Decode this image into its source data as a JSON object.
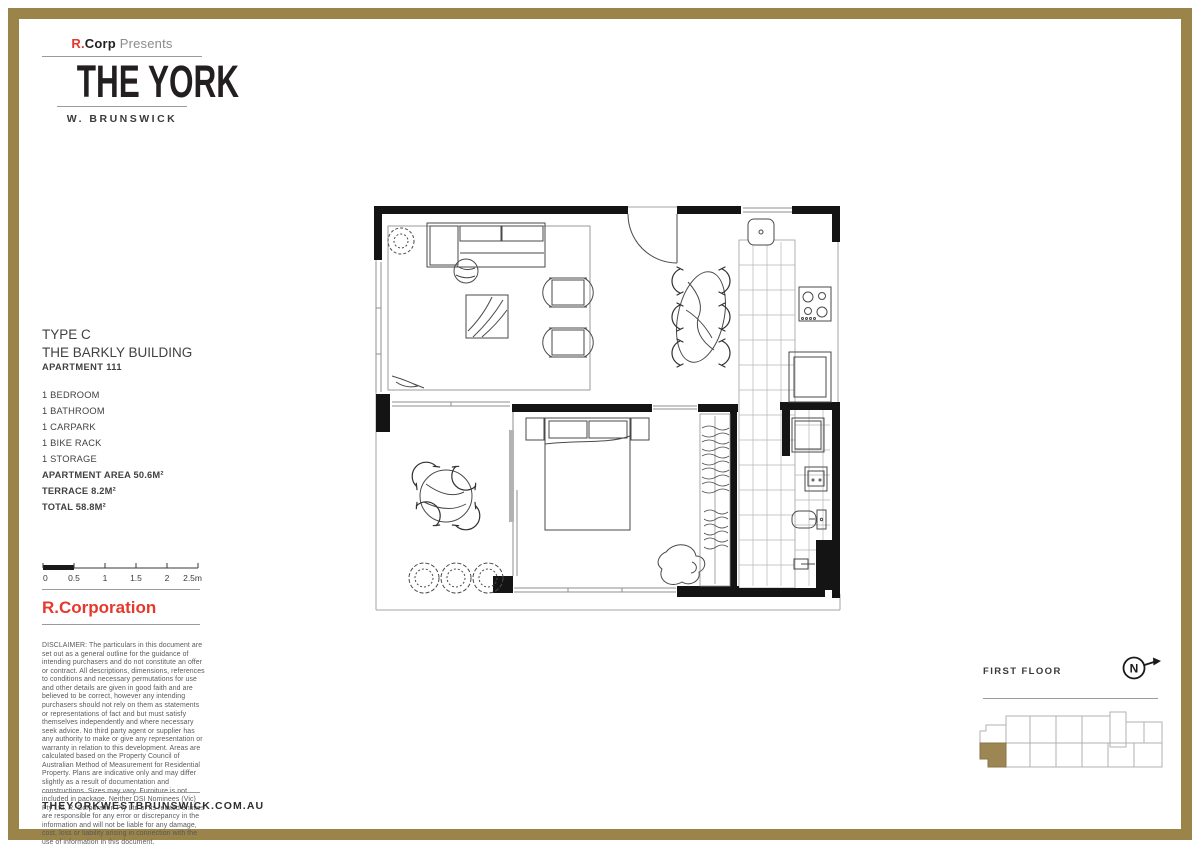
{
  "brand": {
    "mark_r": "R.",
    "mark_corp": "Corp",
    "mark_presents": " Presents",
    "title": "THE YORK",
    "location": "W. BRUNSWICK"
  },
  "unit": {
    "type_line1": "TYPE C",
    "type_line2": "THE BARKLY BUILDING",
    "apartment": "APARTMENT 111",
    "features": [
      "1 BEDROOM",
      "1 BATHROOM",
      "1 CARPARK",
      "1 BIKE RACK",
      "1 STORAGE"
    ],
    "areas": [
      "APARTMENT AREA 50.6M²",
      "TERRACE 8.2M²",
      "TOTAL 58.8M²"
    ]
  },
  "scalebar": {
    "ticks": [
      "0",
      "0.5",
      "1",
      "1.5",
      "2",
      "2.5m"
    ]
  },
  "developer": {
    "name": "R.Corporation"
  },
  "disclaimer": "DISCLAIMER: The particulars in this document are set out as a general outline for the guidance of intending purchasers and do not constitute an offer or contract.  All descriptions, dimensions, references to conditions and necessary permutations for use and other details are given in good faith and are believed to be correct, however any intending purchasers should not rely on them as statements or representations of fact and but must satisfy themselves independently and where necessary seek advice.  No third party agent or supplier has any authority to make or give any representation or warranty in relation to this development. Areas are calculated based on the Property Council of Australian Method of Measurement for Residential Property. Plans are indicative only and may differ slightly as a result of documentation and constructions. Sizes may vary. Furniture is not included in package. Neither DSI Nominees (Vic) Pty Ltd, R. Corporation Pty Ltd or its related entities are responsible for any error or discrepancy in the information and will not be liable for any damage, cost, loss or liability arising in connection with the use of information in this document.",
  "website": "THEYORKWESTBRUNSWICK.COM.AU",
  "keyplan": {
    "floor": "FIRST FLOOR",
    "north": "N"
  },
  "colors": {
    "gold": "#9A8449",
    "red": "#E6392E",
    "ink": "#231F20",
    "gray_text": "#58595B"
  }
}
